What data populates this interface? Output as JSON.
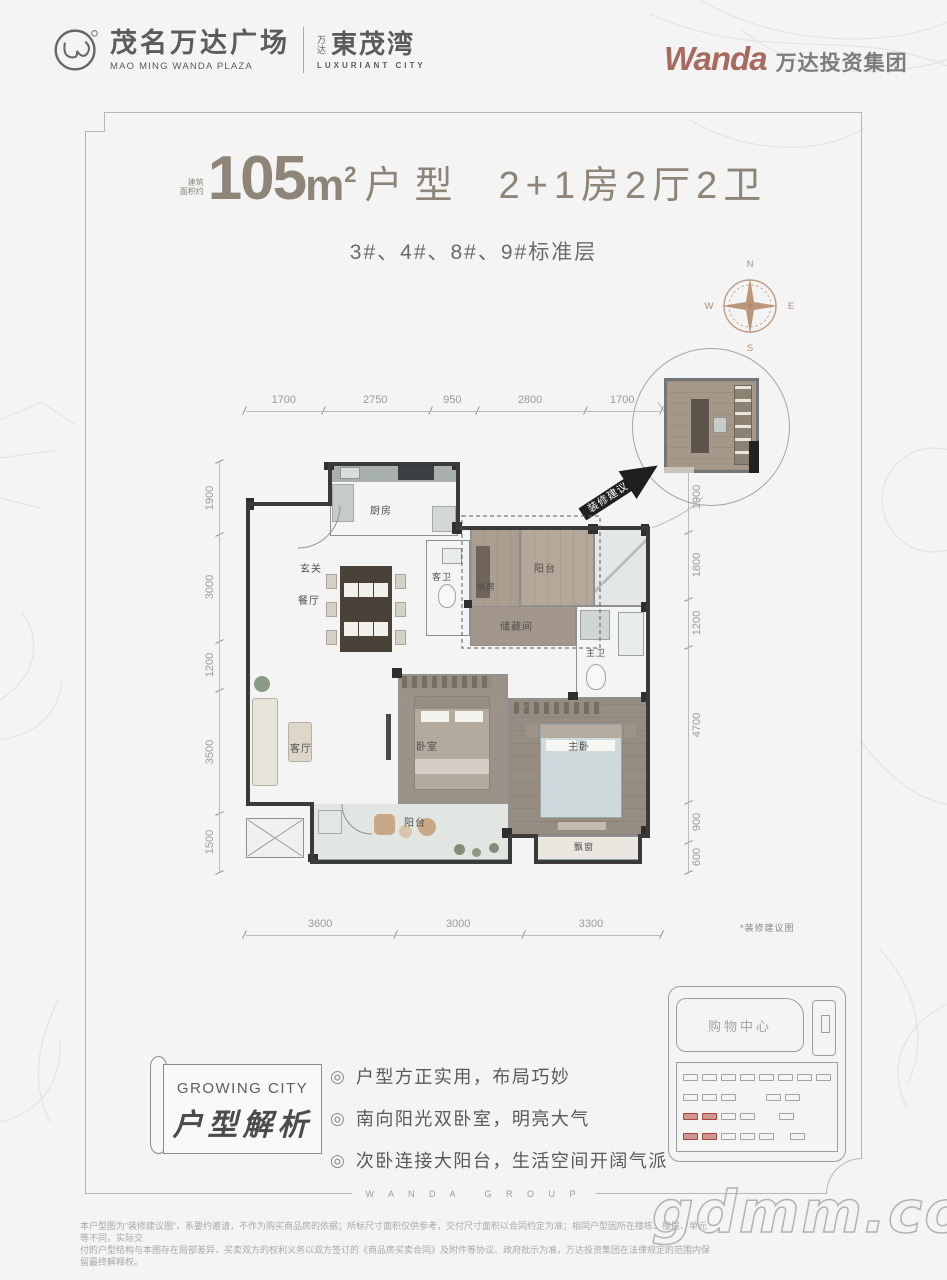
{
  "header": {
    "logo_left": {
      "cn": "茂名万达广场",
      "en": "MAO MING WANDA PLAZA",
      "sub_small": "万达",
      "sub_cn": "東茂湾",
      "sub_en": "LUXURIANT CITY"
    },
    "logo_right": {
      "brand": "Wanda",
      "cn": "万达投资集团"
    }
  },
  "colors": {
    "brand_red": "#a86a5e",
    "title_taupe": "#8e8478",
    "compass_tan": "#b58c6e"
  },
  "title": {
    "area_prefix_line1": "建筑",
    "area_prefix_line2": "面积约",
    "area_number": "105",
    "area_unit": "m",
    "area_sup": "2",
    "type_label": "户型",
    "layout": "2+1房2厅2卫",
    "subtitle": "3#、4#、8#、9#标准层"
  },
  "compass": {
    "n": "N",
    "e": "E",
    "s": "S",
    "w": "W"
  },
  "floorplan": {
    "dims_top": [
      "1700",
      "2750",
      "950",
      "2800",
      "1700"
    ],
    "dims_left": [
      "1900",
      "3000",
      "1200",
      "3500",
      "1500"
    ],
    "dims_right": [
      "1900",
      "1800",
      "1200",
      "4700",
      "900",
      "600"
    ],
    "dims_bottom": [
      "3600",
      "3000",
      "3300"
    ],
    "rooms": {
      "kitchen": "厨房",
      "entry": "玄关",
      "dining": "餐厅",
      "guest_bath": "客卫",
      "study": "书房",
      "balcony_top": "阳台",
      "storage": "储藏间",
      "master_bath": "主卫",
      "living": "客厅",
      "bedroom": "卧室",
      "master_bedroom": "主卧",
      "balcony_bottom": "阳台",
      "bay_window": "飘窗"
    },
    "inset_arrow_label": "装修建议",
    "inset_note": "*装修建议图"
  },
  "analysis": {
    "banner_en": "GROWING CITY",
    "banner_cn": "户型解析",
    "bullet_icon": "◎",
    "bullets": [
      "户型方正实用，布局巧妙",
      "南向阳光双卧室，明亮大气",
      "次卧连接大阳台，生活空间开阔气派"
    ]
  },
  "siteplan": {
    "mall_label": "购物中心"
  },
  "footer": {
    "frame_text": "W A N D A　 G R O U P",
    "disclaimer_line1": "本户型图为“装修建议图”，系要约邀请，不作为购买商品房的依据；所标尺寸面积仅供参考，交付尺寸面积以合同约定为准；相同户型因所在楼栋、楼层、单元等不同，实际交",
    "disclaimer_line2": "付的户型结构与本图存在局部差异，买卖双方的权利义务以双方签订的《商品房买卖合同》及附件等协议、政府批示为准，万达投资集团在法律规定的范围内保留最终解释权。"
  },
  "watermark": "gdmm.com"
}
